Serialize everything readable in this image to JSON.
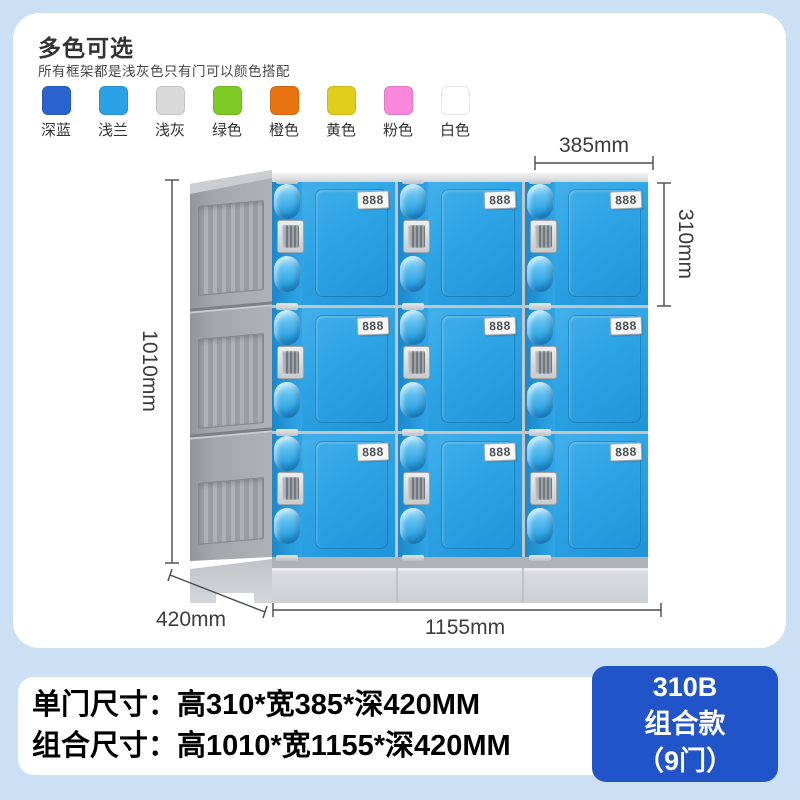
{
  "colors": {
    "page_bg": "#CBDFF5",
    "card_bg": "#FFFFFF",
    "door_blue": "#2FA5E6",
    "frame_gray": "#A9ACAF",
    "badge_blue": "#2154C8",
    "dim_line": "#4A4A4A"
  },
  "header": {
    "title": "多色可选",
    "subtitle": "所有框架都是浅灰色只有门可以颜色搭配"
  },
  "swatches": [
    {
      "label": "深蓝",
      "color": "#2A62CE"
    },
    {
      "label": "浅兰",
      "color": "#2AA2E5"
    },
    {
      "label": "浅灰",
      "color": "#D9D9D9"
    },
    {
      "label": "绿色",
      "color": "#7ECB26"
    },
    {
      "label": "橙色",
      "color": "#E87310"
    },
    {
      "label": "黄色",
      "color": "#E3CD1B"
    },
    {
      "label": "粉色",
      "color": "#F987DC"
    },
    {
      "label": "白色",
      "color": "#FFFFFF"
    }
  ],
  "locker": {
    "door_label": "888",
    "rows": 3,
    "columns": 3
  },
  "dimensions": {
    "door_width": "385mm",
    "door_height": "310mm",
    "total_height": "1010mm",
    "depth": "420mm",
    "total_width": "1155mm"
  },
  "specs": {
    "single_door": "单门尺寸：高310*宽385*深420MM",
    "combined": "组合尺寸：高1010*宽1155*深420MM"
  },
  "badge": {
    "model": "310B",
    "series": "组合款",
    "doors": "（9门）"
  }
}
